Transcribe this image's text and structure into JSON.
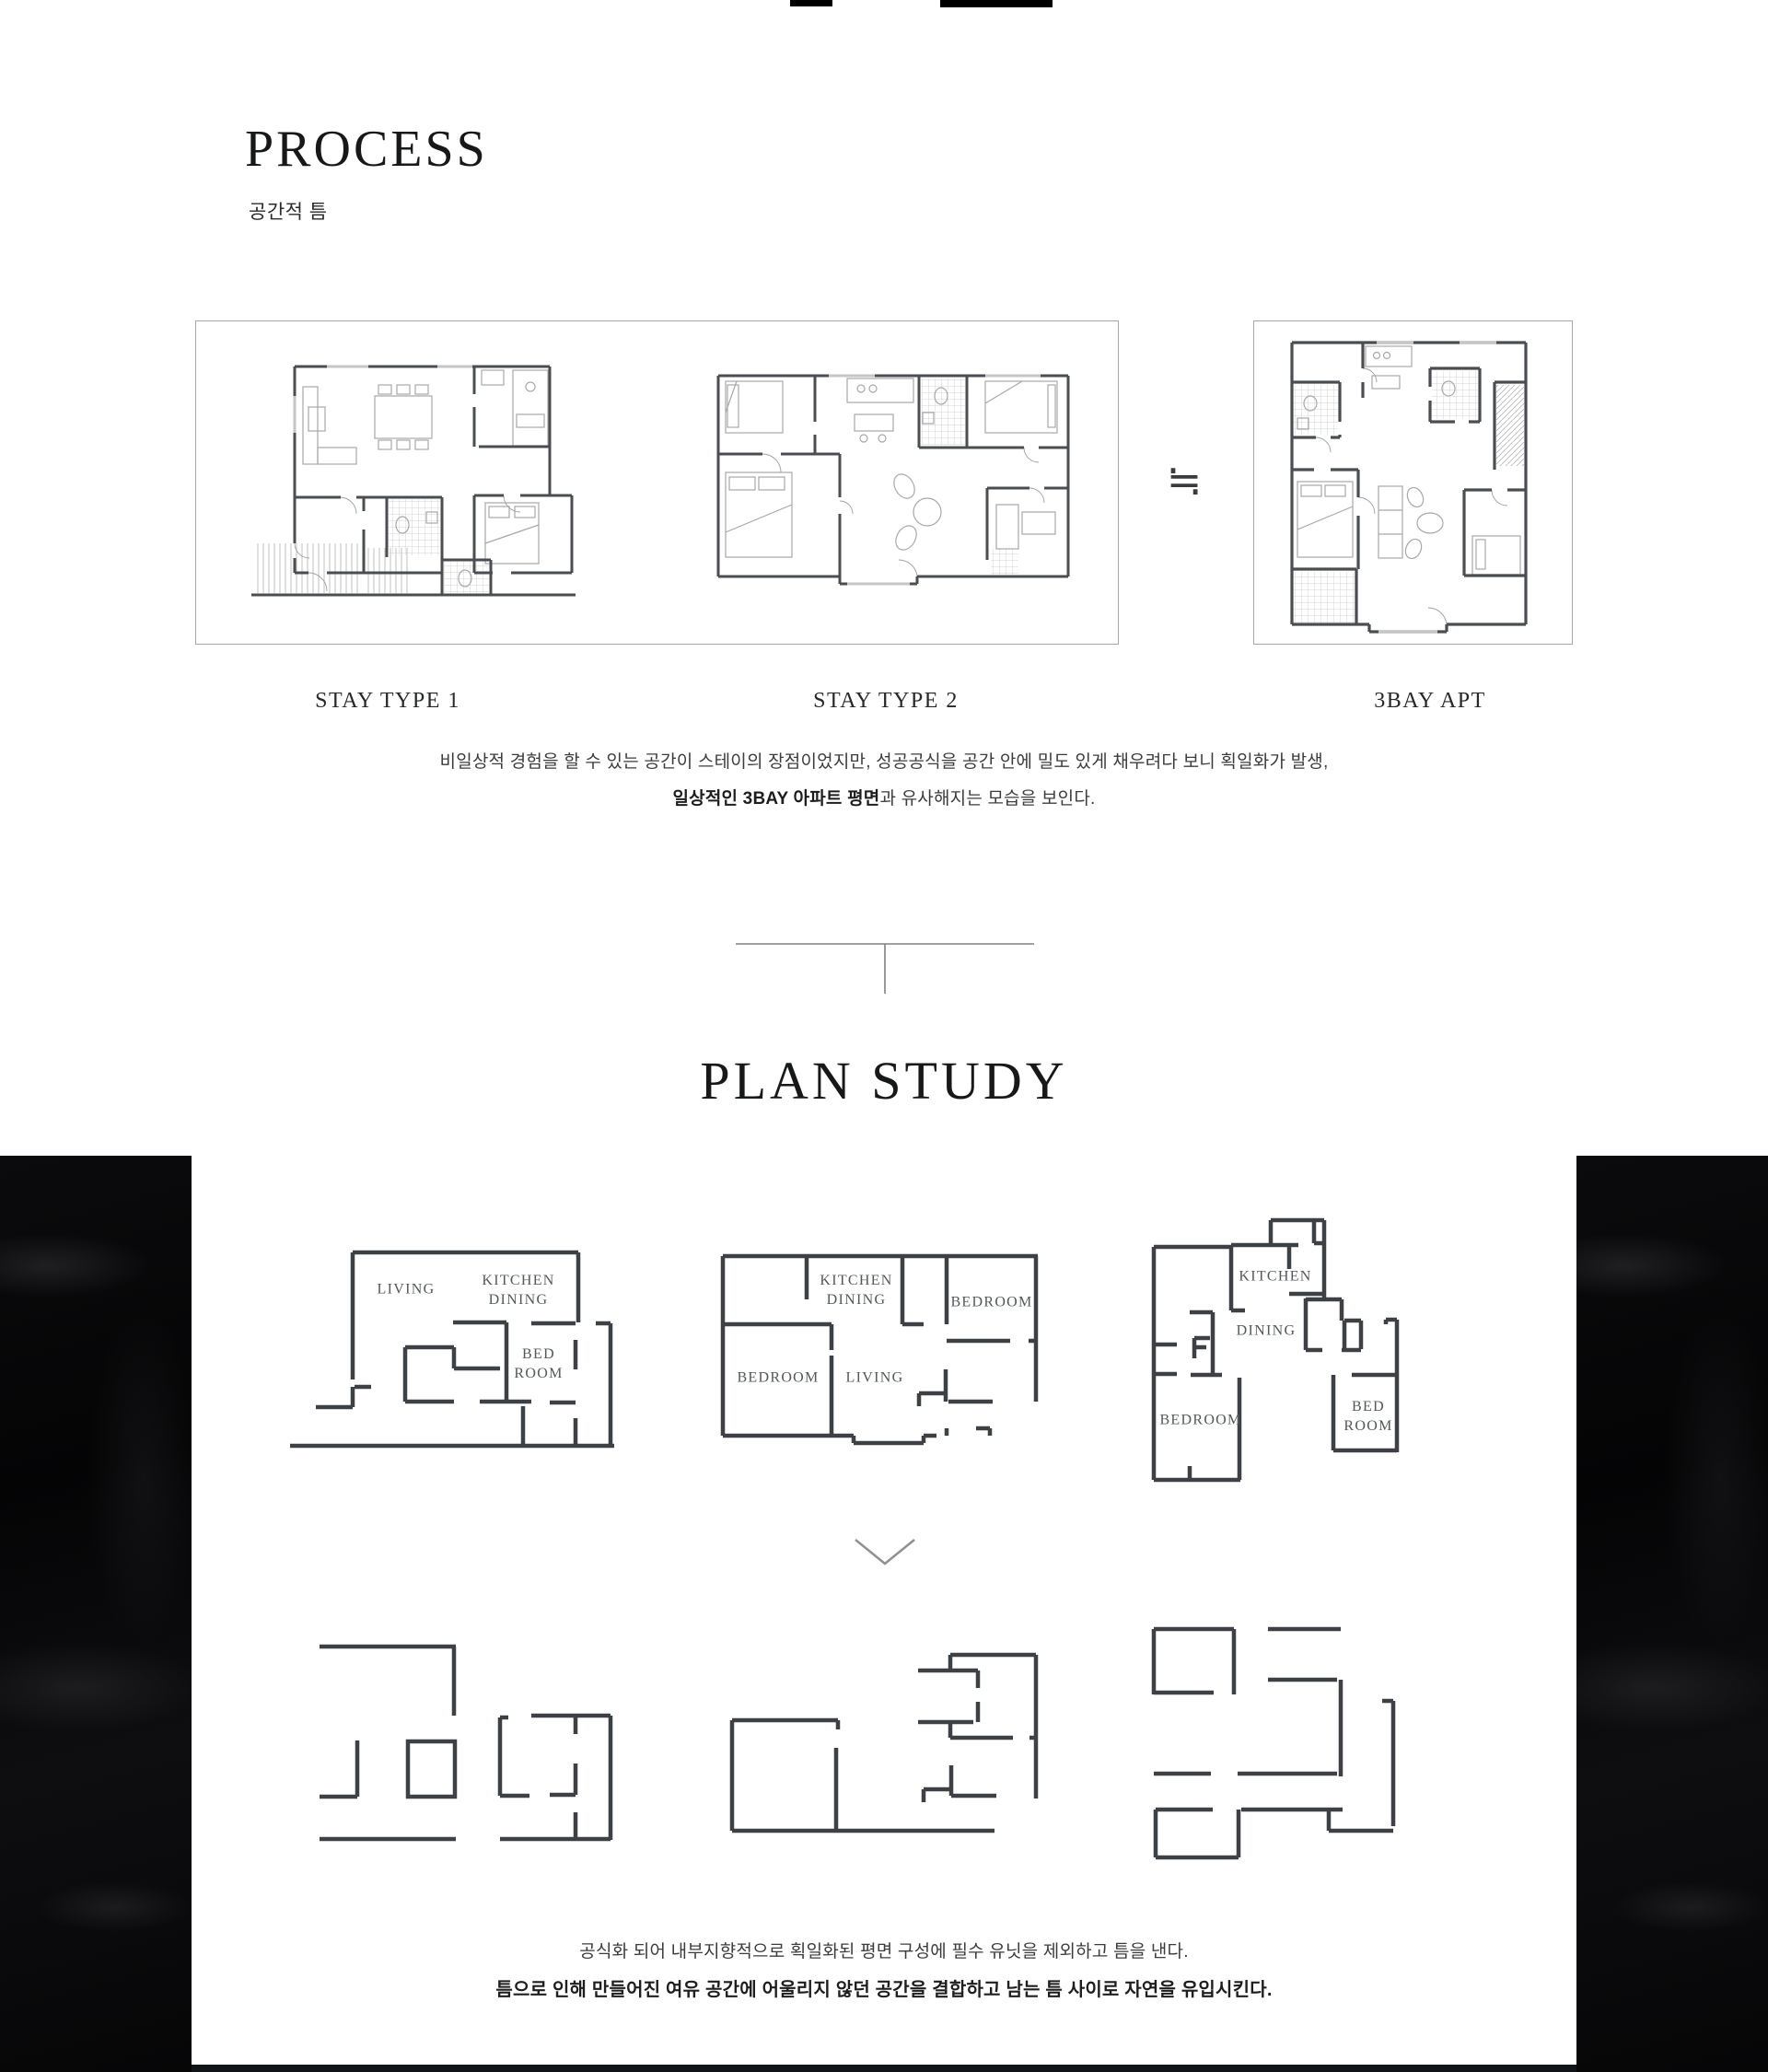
{
  "header": {
    "title": "PROCESS",
    "subtitle": "공간적 틈"
  },
  "process": {
    "plans": [
      {
        "label": "STAY TYPE 1"
      },
      {
        "label": "STAY TYPE 2"
      },
      {
        "label": "3BAY APT"
      }
    ],
    "approx": "≒",
    "caption1": "비일상적 경험을 할 수 있는 공간이 스테이의 장점이었지만, 성공공식을 공간 안에 밀도 있게 채우려다 보니 획일화가 발생,",
    "caption2_bold": "일상적인 3BAY 아파트 평면",
    "caption2_rest": "과 유사해지는 모습을 보인다."
  },
  "plan_study": {
    "title": "PLAN STUDY",
    "a": {
      "living": "LIVING",
      "kitchen": "KITCHEN",
      "dining": "DINING",
      "bed": "BED",
      "room": "ROOM"
    },
    "b": {
      "kitchen": "KITCHEN",
      "dining": "DINING",
      "bedroom_right": "BEDROOM",
      "bedroom_left": "BEDROOM",
      "living": "LIVING"
    },
    "c": {
      "kitchen": "KITCHEN",
      "dining": "DINING",
      "bedroom": "BEDROOM",
      "bed": "BED",
      "room": "ROOM"
    },
    "caption1": "공식화 되어 내부지향적으로 획일화된 평면 구성에 필수 유닛을 제외하고 틈을 낸다.",
    "caption2": "틈으로 인해 만들어진 여유 공간에 어울리지 않던 공간을 결합하고 남는 틈 사이로 자연을 유입시킨다."
  },
  "colors": {
    "wall": "#4a4e52",
    "diagram_wall": "#3d4145",
    "frame_border": "#a6aaad",
    "band": "#060608"
  }
}
